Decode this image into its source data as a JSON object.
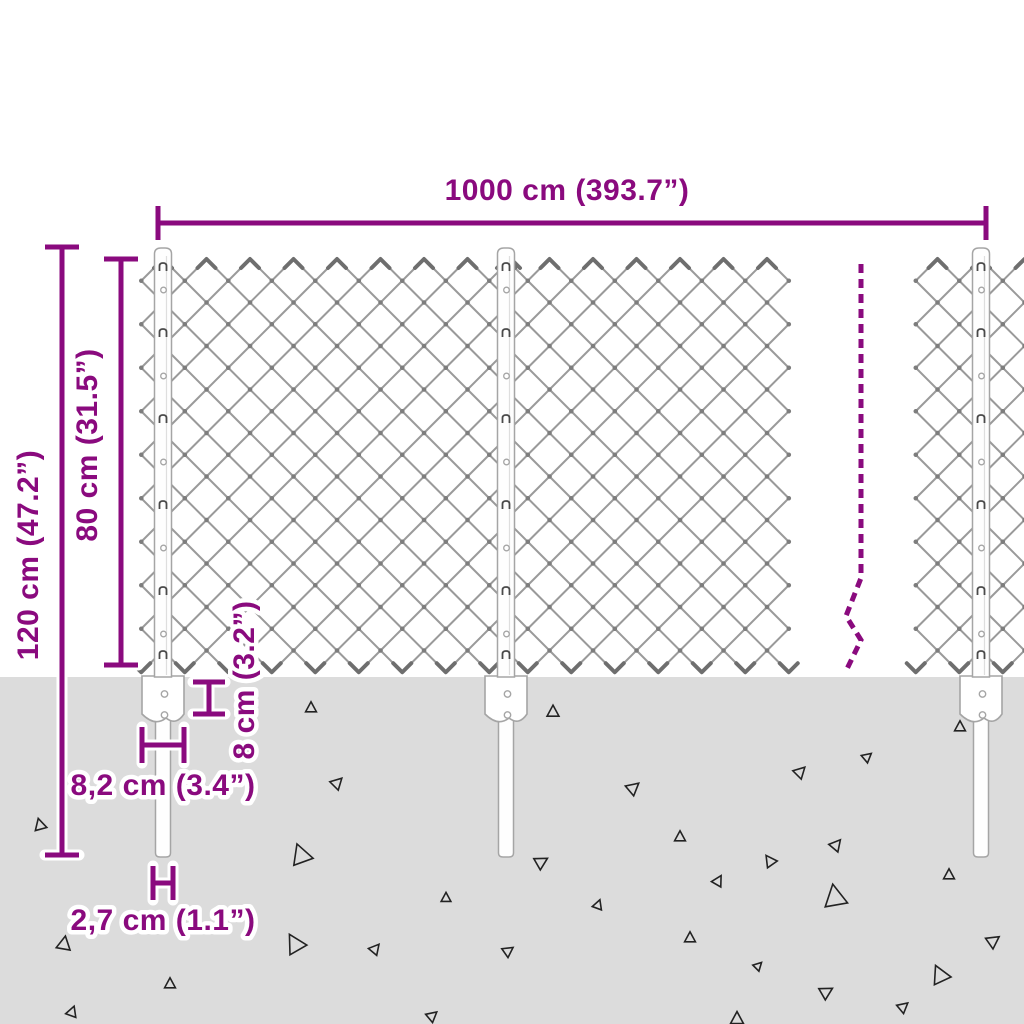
{
  "diagram_title": "chain-link fence with posts - dimension drawing",
  "dimensions": {
    "width": "1000 cm (393.7”)",
    "total_height": "120 cm (47.2”)",
    "mesh_height": "80 cm (31.5”)",
    "anchor_plate_height": "8 cm (3.2”)",
    "anchor_plate_width": "8,2 cm (3.4”)",
    "post_width": "2,7 cm (1.1”)"
  },
  "colors": {
    "accent": "#8a0a7e",
    "halo": "#ffffff",
    "ground": "#dcdcdc",
    "mesh": "#9a9a9a",
    "mesh_knot": "#7d7d7d",
    "mesh_barb": "#6e6e6e",
    "post_fill": "#fefefe",
    "post_outline": "#a5a5a5",
    "clip": "#4a4a4a",
    "triangle": "#222222"
  }
}
